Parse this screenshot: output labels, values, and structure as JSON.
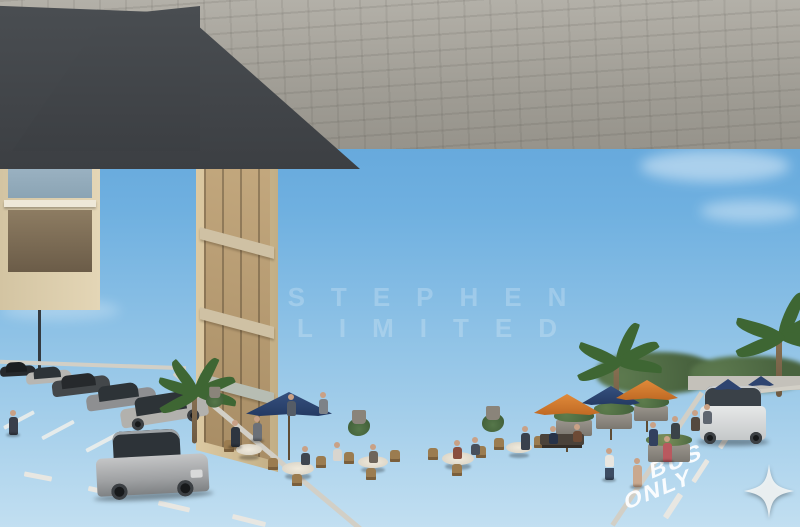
{
  "signs": {
    "main": {
      "line1": "STEPHEN",
      "line2": "FURNITURE"
    },
    "monogram": "STH",
    "outlet": {
      "line1": "STEPHEN",
      "line2": "FURNITURE",
      "badge": "OUTLET"
    }
  },
  "road_markings": {
    "bus": "BUS",
    "only": "ONLY"
  },
  "watermark": {
    "text": "STEPHEN LIMITED"
  },
  "brand_colors": {
    "sign_gold": "#84693a",
    "facade_beige": "#e6d8ba",
    "umbrella_navy": "#2e4470",
    "umbrella_orange": "#d8782e",
    "sky_blue": "#549ad4",
    "asphalt": "#44484c"
  }
}
